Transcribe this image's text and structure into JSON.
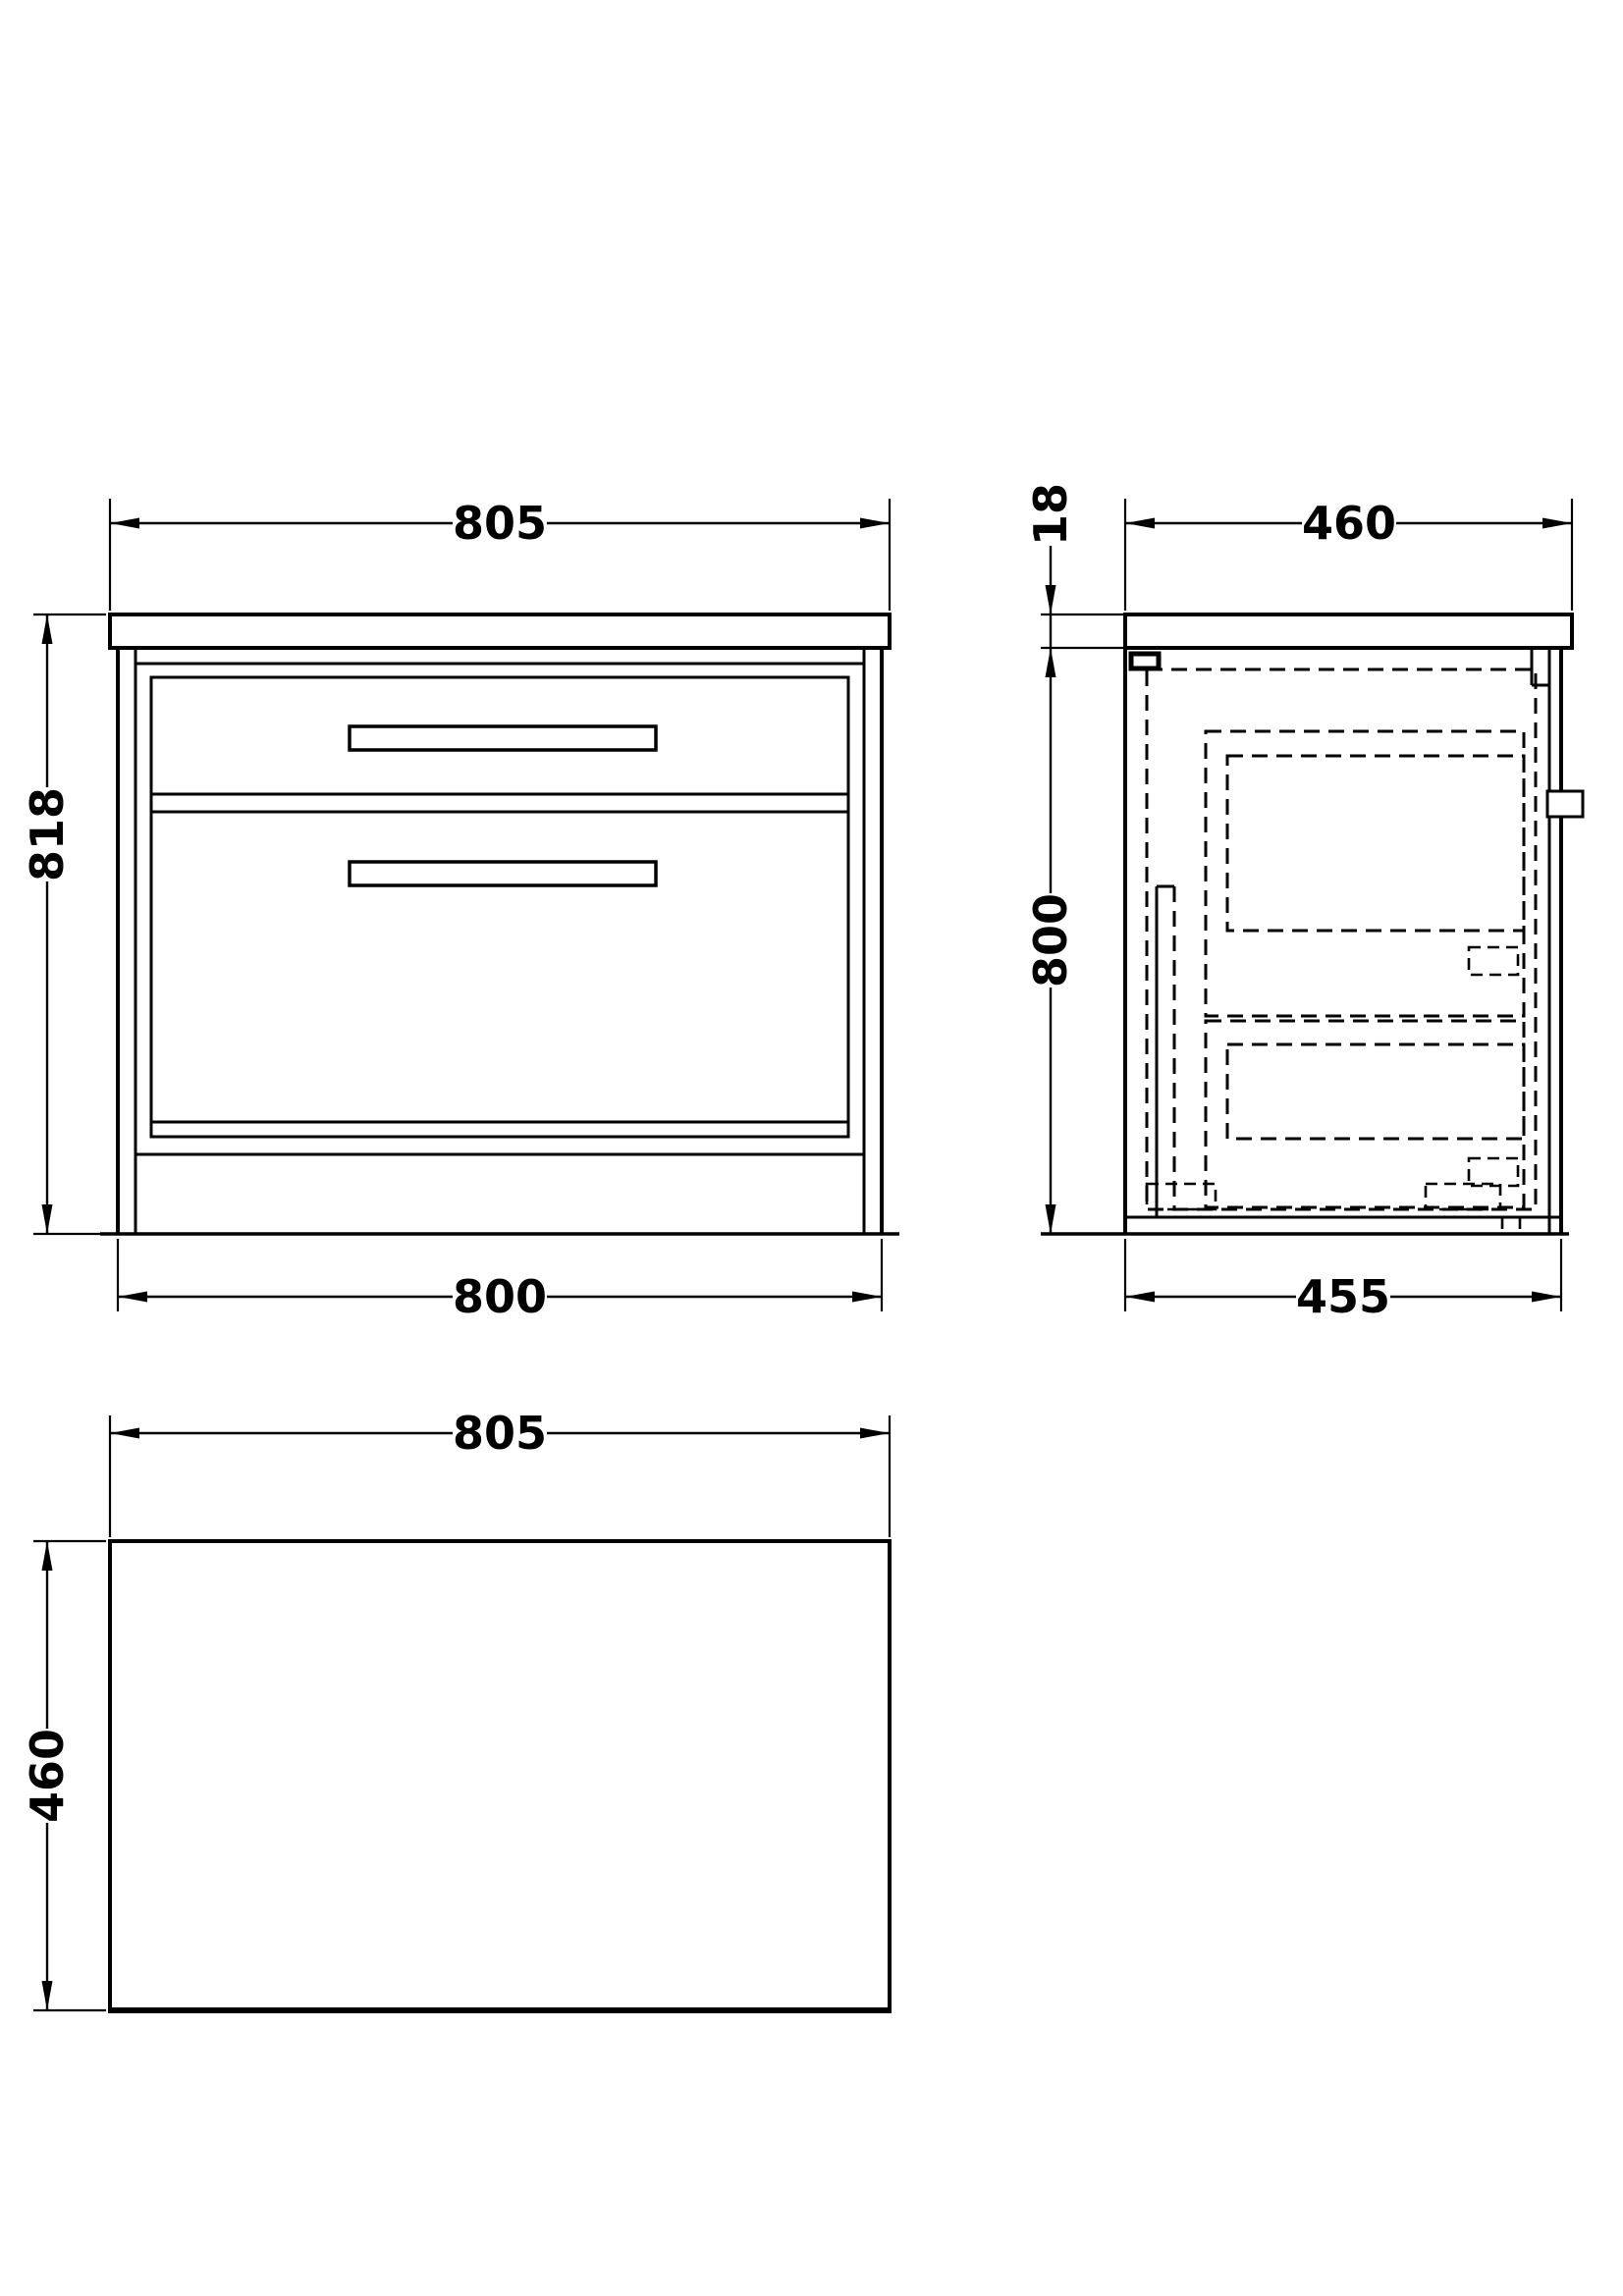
{
  "drawing": {
    "type": "technical-dimension-drawing",
    "subject": "two-drawer floor-standing vanity cabinet",
    "colors": {
      "line": "#000000",
      "background": "#ffffff"
    },
    "views": {
      "front": {
        "label": "front-view",
        "dim_top": "805",
        "dim_left": "818",
        "dim_bottom": "800"
      },
      "side": {
        "label": "side-view",
        "dim_top": "460",
        "dim_thickness": "18",
        "dim_left": "800",
        "dim_bottom": "455"
      },
      "plan": {
        "label": "plan-view",
        "dim_top": "805",
        "dim_left": "460"
      }
    }
  }
}
